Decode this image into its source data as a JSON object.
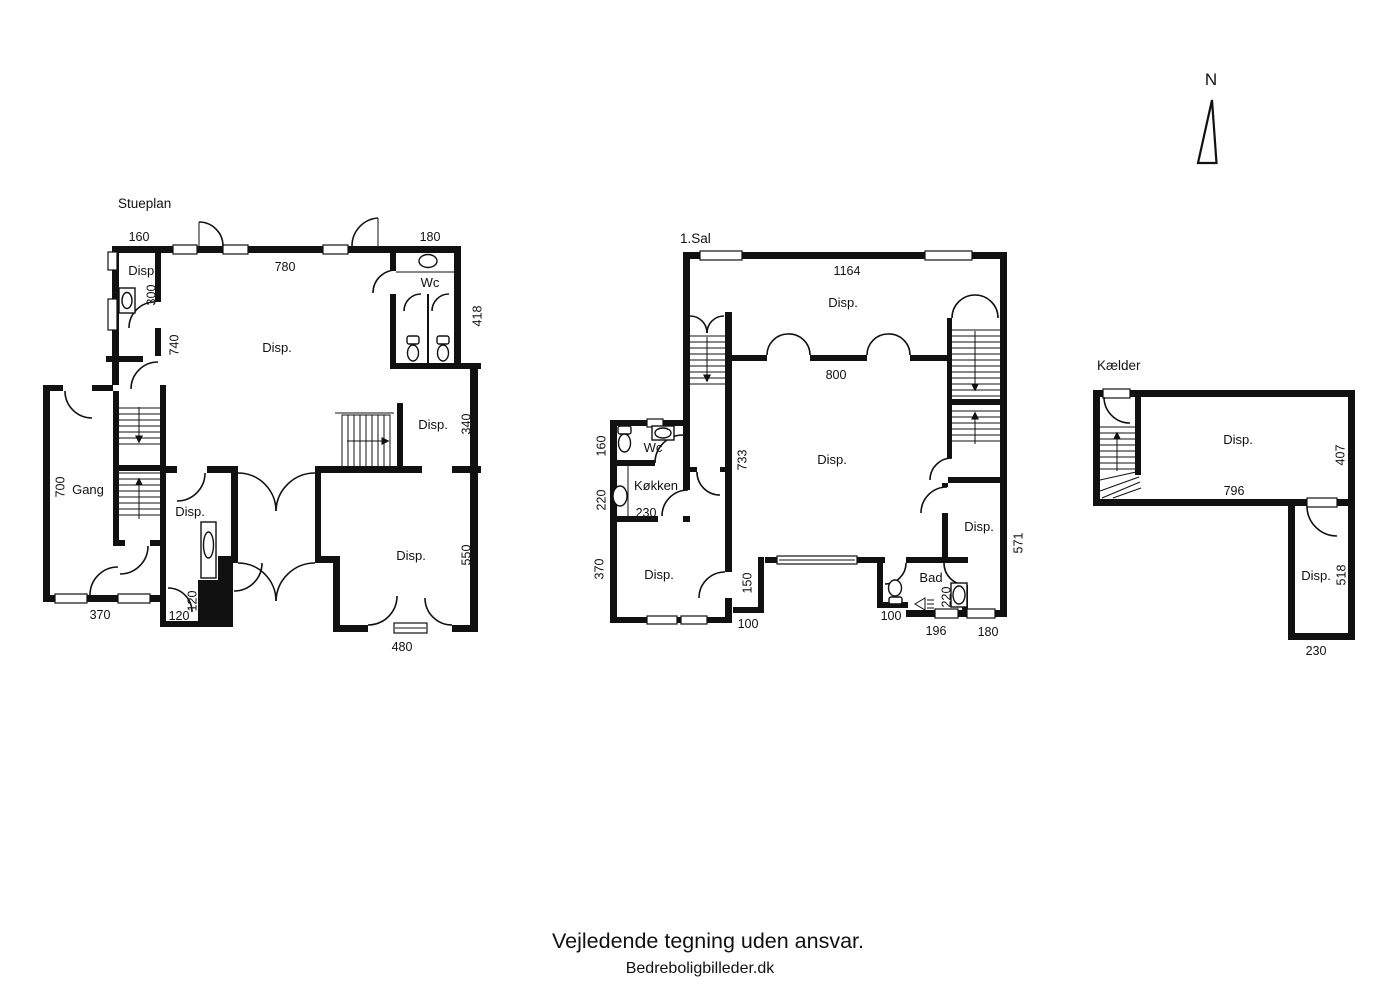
{
  "colors": {
    "ink": "#111111",
    "paper": "#ffffff"
  },
  "north": {
    "label": "N"
  },
  "footer": {
    "disclaimer": "Vejledende tegning uden ansvar.",
    "credit": "Bedreboligbilleder.dk"
  },
  "stueplan": {
    "title": "Stueplan",
    "rooms": {
      "disp_nw": "Disp.",
      "disp_main": "Disp.",
      "wc": "Wc",
      "disp_east": "Disp.",
      "gang": "Gang",
      "disp_inner": "Disp.",
      "disp_south": "Disp."
    },
    "dims": {
      "w160": "160",
      "w780": "780",
      "w180": "180",
      "h300": "300",
      "h740": "740",
      "h418": "418",
      "h340": "340",
      "h700": "700",
      "h550": "550",
      "w370": "370",
      "h120": "120",
      "w120": "120",
      "w480": "480"
    }
  },
  "first_floor": {
    "title": "1.Sal",
    "rooms": {
      "disp_north": "Disp.",
      "disp_main": "Disp.",
      "wc": "Wc",
      "koekken": "Køkken",
      "disp_sw": "Disp.",
      "bad": "Bad",
      "disp_east": "Disp."
    },
    "dims": {
      "w1164": "1164",
      "w800": "800",
      "h733": "733",
      "h160": "160",
      "h220": "220",
      "w230": "230",
      "h370": "370",
      "h150": "150",
      "w100_left": "100",
      "w100_right": "100",
      "h220_bad": "220",
      "w196": "196",
      "w180": "180",
      "h571": "571"
    }
  },
  "basement": {
    "title": "Kælder",
    "rooms": {
      "disp_main": "Disp.",
      "disp_south": "Disp."
    },
    "dims": {
      "h407": "407",
      "w796": "796",
      "h518": "518",
      "w230": "230"
    }
  }
}
